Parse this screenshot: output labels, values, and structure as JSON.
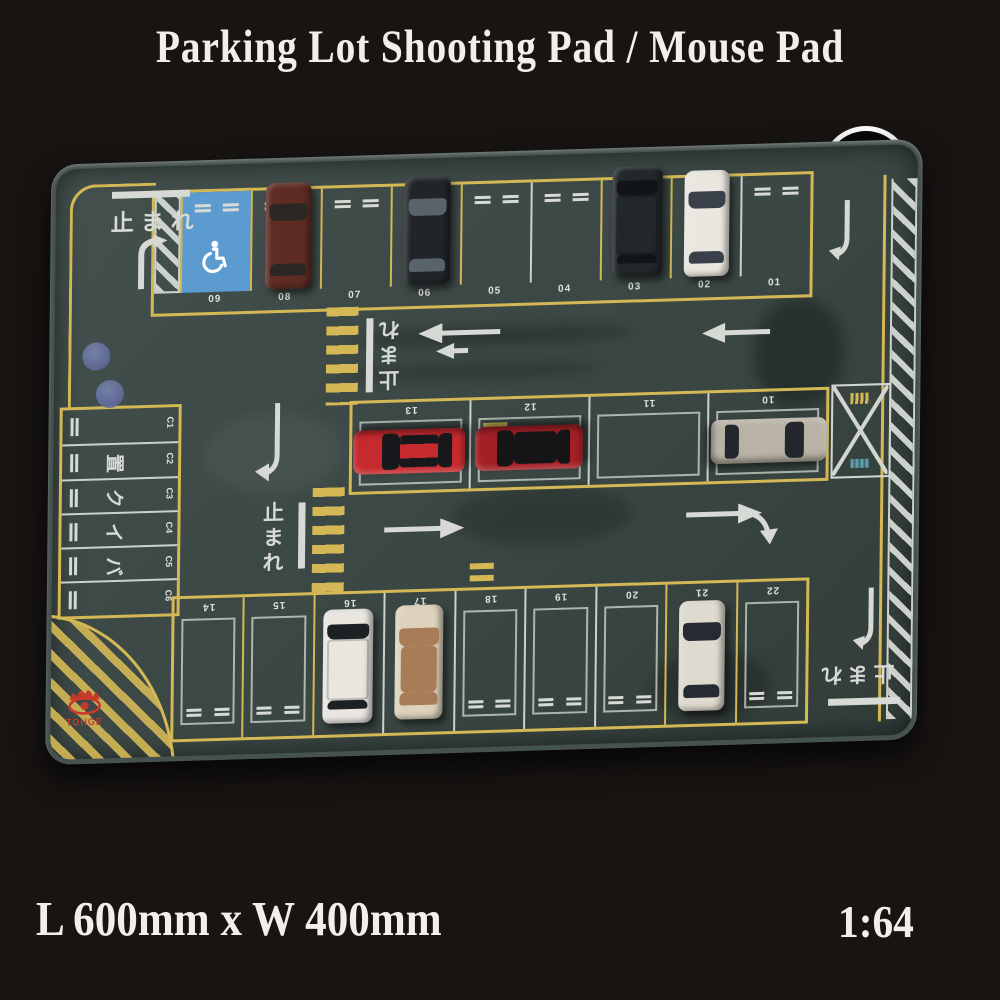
{
  "title": "Parking Lot Shooting Pad / Mouse Pad",
  "badge_letter": "F",
  "footer": {
    "size_label": "L 600mm x W 400mm",
    "scale_label": "1:64"
  },
  "brand_logo": {
    "text": "TOHGE",
    "color": "#c8392b"
  },
  "lot": {
    "stop_text": "止まれ",
    "top_row": [
      "09",
      "08",
      "07",
      "06",
      "05",
      "04",
      "03",
      "02",
      "01"
    ],
    "mid_row": [
      "13",
      "12",
      "11",
      "10"
    ],
    "bottom_row": [
      "14",
      "15",
      "16",
      "17",
      "18",
      "19",
      "20",
      "21",
      "22"
    ],
    "c_column": [
      "C1",
      "C2",
      "C3",
      "C4",
      "C5",
      "C6"
    ],
    "bike_chars": [
      "置",
      "ク",
      "イ",
      "バ"
    ],
    "colors": {
      "surface": "#404c49",
      "line_yellow": "#d3b855",
      "line_white": "#ccd1cb",
      "handicap_blue": "#5b9bd0",
      "background": "#171412"
    },
    "cars": [
      {
        "space": "08",
        "desc": "maroon sedan",
        "body": "#5f2c24",
        "glass": "#2b2722"
      },
      {
        "space": "06",
        "desc": "black sedan",
        "body": "#212529",
        "glass": "#59636c"
      },
      {
        "space": "03",
        "desc": "black suv",
        "body": "#22282a",
        "glass": "#121517"
      },
      {
        "space": "02",
        "desc": "white sedan",
        "body": "#e9e7e0",
        "glass": "#394049"
      },
      {
        "space": "13",
        "desc": "red sports car",
        "body": "#c52a2e",
        "glass": "#17181c"
      },
      {
        "space": "12",
        "desc": "red roadster",
        "body": "#a32026",
        "glass": "#151518"
      },
      {
        "space": "10",
        "desc": "champagne coupe",
        "body": "#b9b3a5",
        "glass": "#23262b"
      },
      {
        "space": "16",
        "desc": "white suv",
        "body": "#e8e6df",
        "glass": "#1e2124"
      },
      {
        "space": "17",
        "desc": "cream open-top sedan",
        "body": "#ddd3bd",
        "glass": "#a87c57"
      },
      {
        "space": "21",
        "desc": "pearl sedan",
        "body": "#dedacf",
        "glass": "#262a33"
      }
    ]
  }
}
